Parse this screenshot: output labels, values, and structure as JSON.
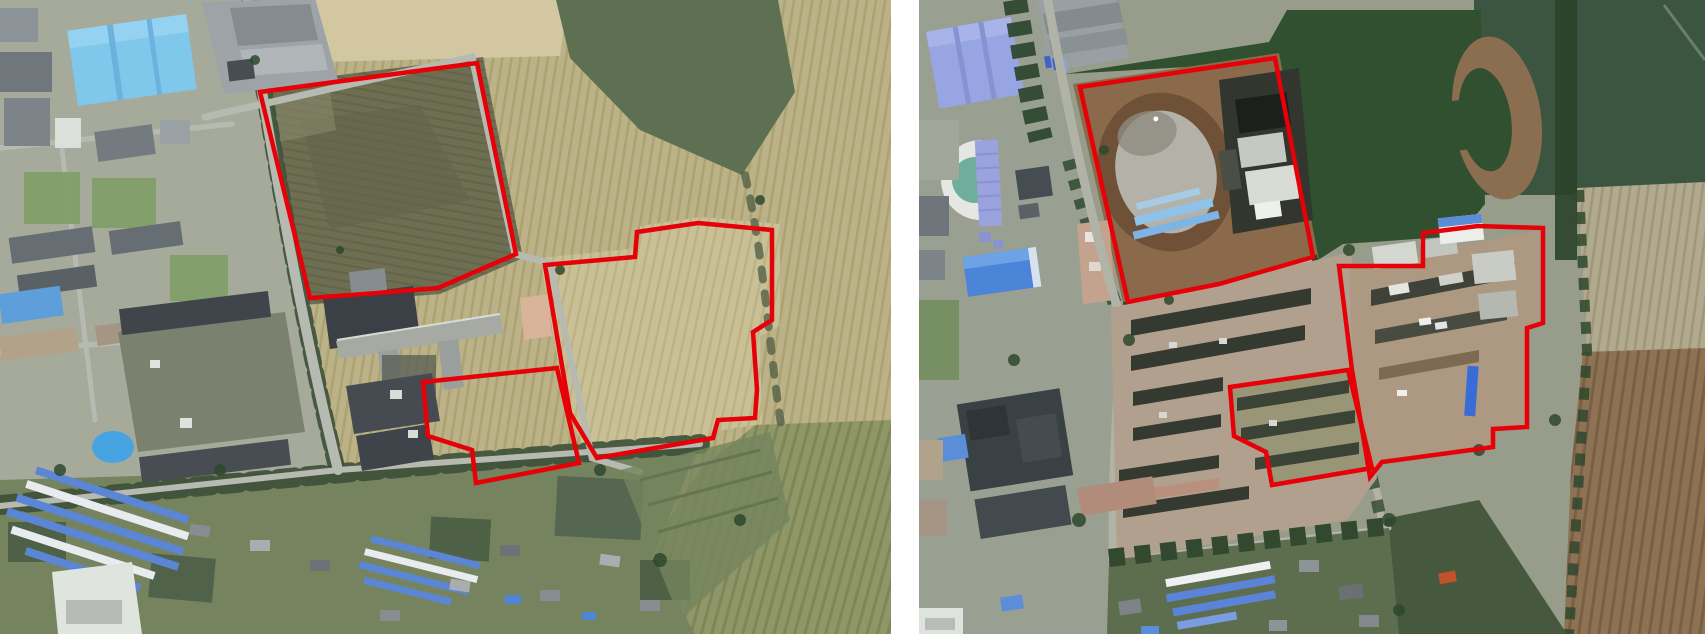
{
  "colors": {
    "annotation": "#e60008",
    "gap_background": "#ffffff"
  },
  "annotation_style": {
    "stroke_width": 4.5
  },
  "panels": [
    {
      "name": "satellite-image-left",
      "annotations": [
        {
          "name": "north-field-boundary",
          "points": [
            [
              260,
              92
            ],
            [
              477,
              63
            ],
            [
              516,
              254
            ],
            [
              438,
              288
            ],
            [
              378,
              293
            ],
            [
              310,
              298
            ]
          ]
        },
        {
          "name": "small-lot-boundary",
          "points": [
            [
              423,
              382
            ],
            [
              557,
              368
            ],
            [
              579,
              463
            ],
            [
              476,
              483
            ],
            [
              472,
              450
            ],
            [
              428,
              436
            ]
          ]
        },
        {
          "name": "east-field-boundary",
          "points": [
            [
              545,
              265
            ],
            [
              635,
              257
            ],
            [
              637,
              232
            ],
            [
              698,
              223
            ],
            [
              772,
              230
            ],
            [
              772,
              320
            ],
            [
              753,
              332
            ],
            [
              757,
              390
            ],
            [
              755,
              418
            ],
            [
              718,
              420
            ],
            [
              713,
              438
            ],
            [
              597,
              458
            ],
            [
              570,
              413
            ]
          ]
        }
      ]
    },
    {
      "name": "satellite-image-right",
      "annotations": [
        {
          "name": "stadium-site-boundary",
          "points": [
            [
              161,
              87
            ],
            [
              356,
              58
            ],
            [
              394,
              257
            ],
            [
              300,
              284
            ],
            [
              209,
              302
            ]
          ]
        },
        {
          "name": "construction-site-boundary",
          "points": [
            [
              420,
              266
            ],
            [
              504,
              266
            ],
            [
              504,
              233
            ],
            [
              559,
              226
            ],
            [
              624,
              228
            ],
            [
              624,
              323
            ],
            [
              608,
              328
            ],
            [
              608,
              427
            ],
            [
              574,
              429
            ],
            [
              574,
              447
            ],
            [
              463,
              462
            ],
            [
              451,
              477
            ],
            [
              433,
              370
            ]
          ]
        },
        {
          "name": "barracks-site-boundary",
          "points": [
            [
              311,
              387
            ],
            [
              429,
              370
            ],
            [
              453,
              468
            ],
            [
              353,
              485
            ],
            [
              347,
              452
            ],
            [
              315,
              436
            ]
          ]
        }
      ]
    }
  ]
}
